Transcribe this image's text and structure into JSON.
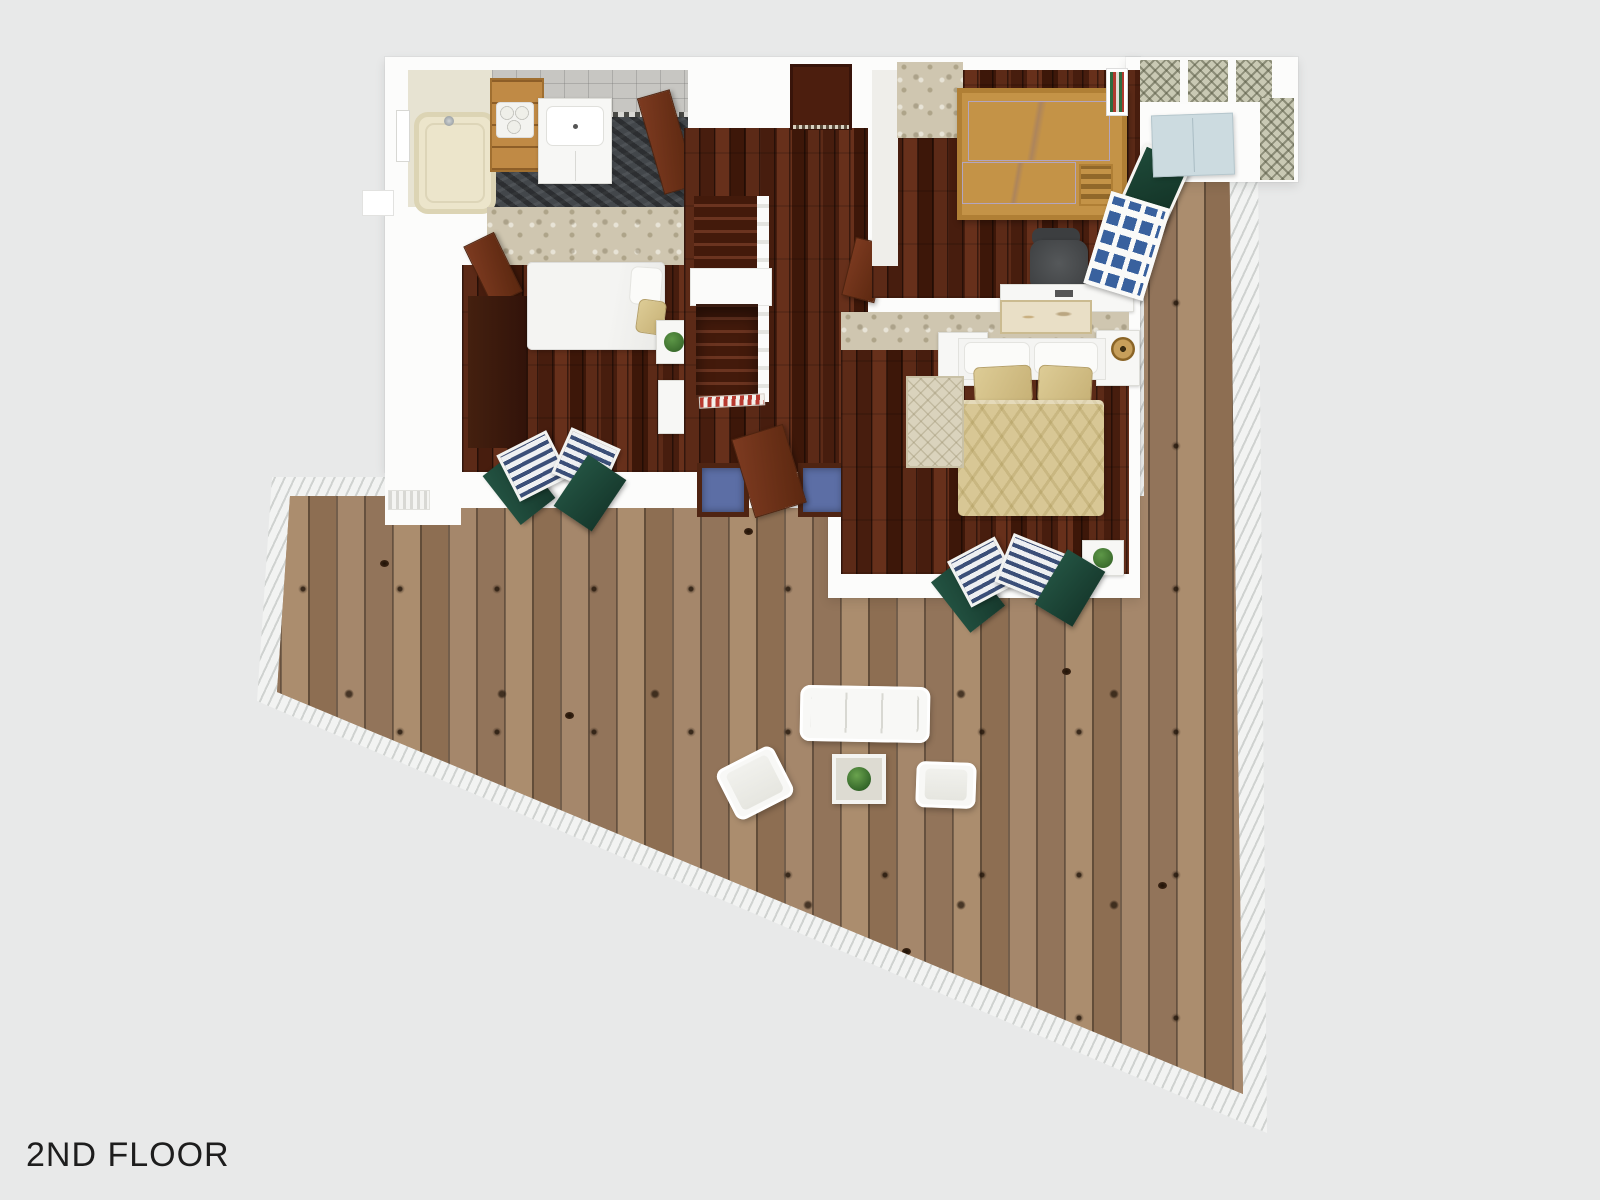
{
  "floorplan": {
    "floor_label": "2ND FLOOR"
  },
  "colors": {
    "bg": "#e8e9e9",
    "wall": "#fcfcfb",
    "deck-wood": "#9b7c5f",
    "deck-rail": "#f2f3f2",
    "interior-wood": "#4f2012",
    "carpet": "#cfc6b0",
    "slate": "#43474b",
    "tub": "#ece5cb",
    "shelf-wood": "#c08a45",
    "door-brown": "#6f3016",
    "shutter-green": "#1f4d3b",
    "shutter-slat": "#3b4f78",
    "bunk-wood": "#c49347",
    "lavender": "#cfc3d8",
    "tan-bed": "#d8c795",
    "blue-recess": "#5c6ea5",
    "cabinet-blue": "#ccdbe0",
    "lattice": "#c9c9b4",
    "label": "#1d1d1d"
  }
}
